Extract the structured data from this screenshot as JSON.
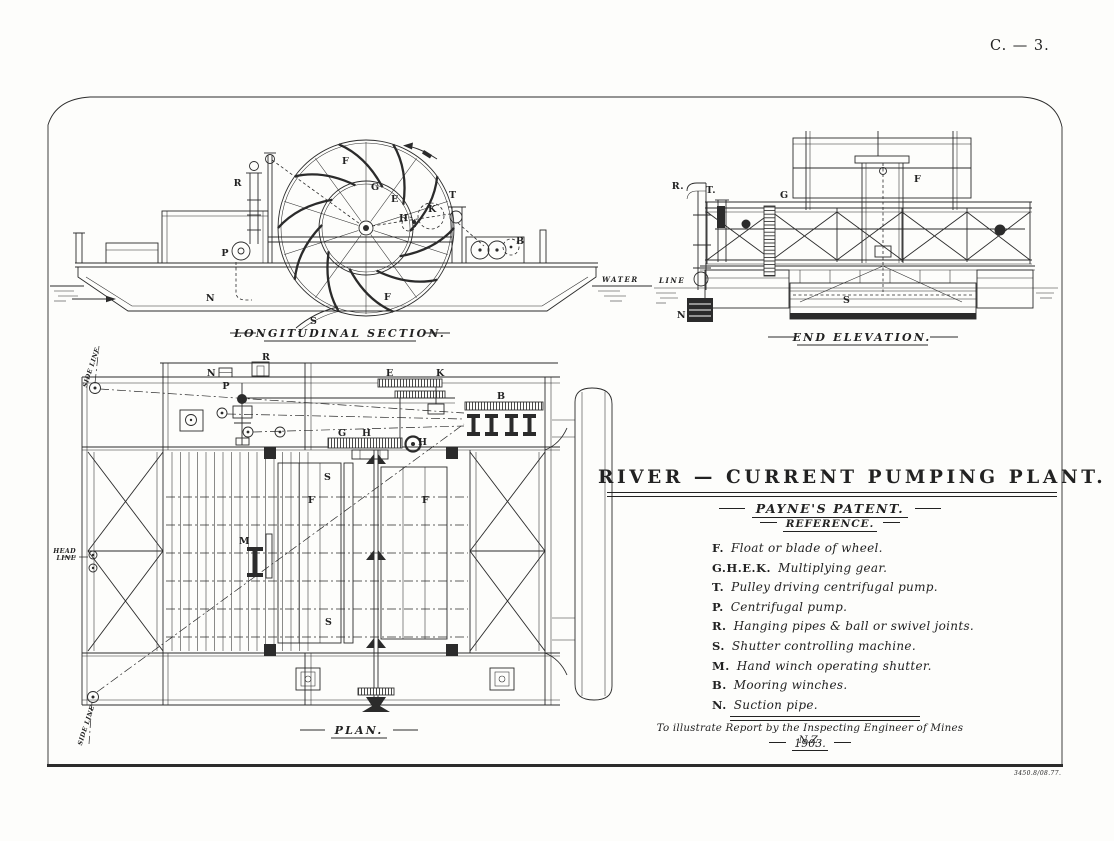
{
  "page": {
    "plate_number": "C. — 3.",
    "print_code": "3450.8/08.77.",
    "paper_color": "#fdfdfb",
    "ink_color": "#2b2b2b"
  },
  "title_block": {
    "title": "RIVER — CURRENT PUMPING PLANT.",
    "subtitle": "PAYNE'S PATENT.",
    "reference_heading": "REFERENCE.",
    "reference_items": [
      {
        "key": "F.",
        "desc": "Float or blade of wheel."
      },
      {
        "key": "G.H.E.K.",
        "desc": "Multiplying gear."
      },
      {
        "key": "T.",
        "desc": "Pulley driving centrifugal pump."
      },
      {
        "key": "P.",
        "desc": "Centrifugal pump."
      },
      {
        "key": "R.",
        "desc": "Hanging pipes & ball or swivel joints."
      },
      {
        "key": "S.",
        "desc": "Shutter controlling machine."
      },
      {
        "key": "M.",
        "desc": "Hand winch operating shutter."
      },
      {
        "key": "B.",
        "desc": "Mooring winches."
      },
      {
        "key": "N.",
        "desc": "Suction pipe."
      }
    ],
    "attribution": "To illustrate Report by the Inspecting Engineer of Mines N.Z.",
    "year": "1903."
  },
  "views": {
    "longitudinal": {
      "caption": "LONGITUDINAL SECTION.",
      "water_label": "WATER",
      "labels": {
        "f_top": "F",
        "r": "R",
        "p": "P",
        "n": "N",
        "s": "S",
        "g": "G",
        "e": "E",
        "h": "H",
        "k": "K",
        "t": "T",
        "f_bottom": "F",
        "b": "B"
      }
    },
    "end_elevation": {
      "caption": "END ELEVATION.",
      "line_label": "LINE",
      "labels": {
        "r": "R.",
        "t": "T.",
        "g": "G",
        "f": "F",
        "s": "S",
        "n": "N"
      }
    },
    "plan": {
      "caption": "PLAN.",
      "head_line_1": "HEAD",
      "head_line_2": "LINE",
      "side_line_top": "SIDE LINE",
      "side_line_bottom": "SIDE LINE",
      "labels": {
        "r": "R",
        "n": "N",
        "p": "P",
        "e": "E",
        "k": "K",
        "b": "B",
        "g": "G",
        "h1": "H",
        "h2": "H",
        "s_top": "S",
        "f_left": "F",
        "f_right": "F",
        "m": "M",
        "s_bottom": "S"
      }
    }
  }
}
